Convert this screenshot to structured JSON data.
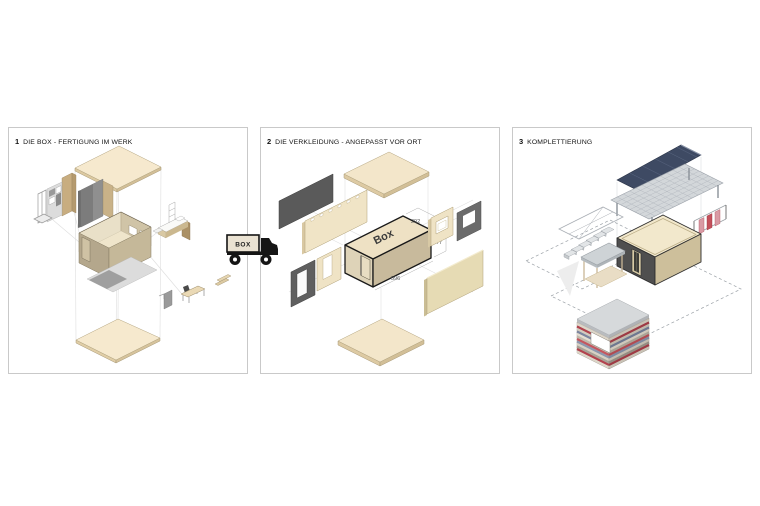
{
  "page": {
    "background_color": "#ffffff"
  },
  "panels": [
    {
      "number": "1",
      "title": "DIE BOX - FERTIGUNG IM WERK"
    },
    {
      "number": "2",
      "title": "DIE VERKLEIDUNG - ANGEPASST VOR ORT",
      "box_label": "Box",
      "dimensions": {
        "depth": "292",
        "height": "277",
        "length": "596"
      }
    },
    {
      "number": "3",
      "title": "KOMPLETTIERUNG"
    }
  ],
  "truck": {
    "cargo_label": "BOX"
  },
  "colors": {
    "panel_border": "#c9c9c9",
    "cream_slab": "#f3e6ca",
    "tan_wall": "#c8ba9c",
    "dark_cladding": "#5a5a5a",
    "solar_navy": "#3e4a63",
    "slat_red": "#c4515c"
  }
}
